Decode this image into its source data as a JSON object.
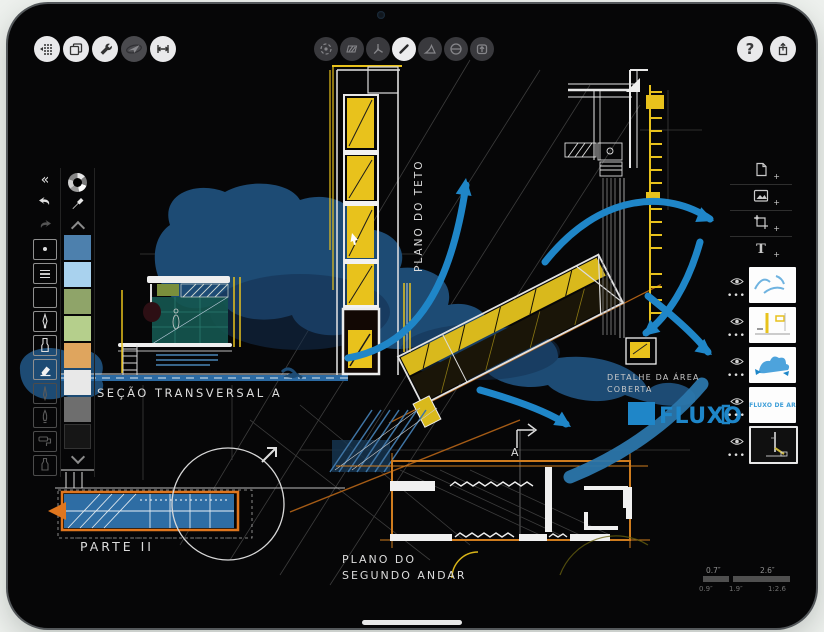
{
  "colors": {
    "accent_blue": "#1f86c8",
    "accent_yellow": "#e8c21c",
    "accent_orange": "#e0761e",
    "blob_blue": "#1d4b74",
    "teal_fill": "#15564f",
    "background": "#eef1ee"
  },
  "top_toolbar": {
    "left_buttons": [
      {
        "icon": "grid-precision-icon"
      },
      {
        "icon": "pages-icon"
      },
      {
        "icon": "wrench-icon"
      },
      {
        "icon": "paper-plane-icon",
        "state": "dimmed"
      },
      {
        "icon": "measure-icon"
      }
    ],
    "center_buttons": [
      {
        "icon": "selection-loop-icon"
      },
      {
        "icon": "hatch-fill-icon"
      },
      {
        "icon": "compass-icon"
      },
      {
        "icon": "line-tool-icon",
        "state": "active"
      },
      {
        "icon": "triangle-tool-icon"
      },
      {
        "icon": "circle-slash-icon"
      },
      {
        "icon": "export-box-icon"
      }
    ],
    "right_buttons": [
      {
        "icon": "help-icon",
        "glyph": "?"
      },
      {
        "icon": "share-icon"
      }
    ]
  },
  "left_panel": {
    "collapse_glyph": "«",
    "undo_icon": "undo-arrow",
    "redo_icon": "redo-arrow",
    "tools": [
      {
        "icon": "dot-tip-icon"
      },
      {
        "icon": "line-weights-icon"
      },
      {
        "icon": "empty-slot"
      },
      {
        "icon": "airbrush-icon"
      },
      {
        "icon": "marker-icon"
      },
      {
        "icon": "eraser-icon",
        "state": "active"
      },
      {
        "icon": "pencil-icon",
        "state": "dimmed"
      },
      {
        "icon": "brush-icon",
        "state": "dimmed"
      },
      {
        "icon": "roller-icon",
        "state": "dimmed"
      },
      {
        "icon": "ink-bottle-icon",
        "state": "dimmed"
      }
    ],
    "palette": {
      "wheel_icon": "color-wheel",
      "dropper_icon": "eyedropper",
      "colors": [
        "#4d80ad",
        "#a9d2ee",
        "#8fa469",
        "#b5cf8c",
        "#dfa55e",
        "#e8e8e8",
        "#6e6e6e",
        "#161616"
      ]
    }
  },
  "right_panel": {
    "add_buttons": [
      {
        "icon": "new-page-icon"
      },
      {
        "icon": "add-image-icon"
      },
      {
        "icon": "crop-icon"
      },
      {
        "icon": "add-text-icon",
        "glyph": "T"
      }
    ],
    "layers": [
      {
        "thumb": "blue-arrow-strokes",
        "visible": true
      },
      {
        "thumb": "plan-sketch",
        "visible": true
      },
      {
        "thumb": "blue-blob",
        "visible": true
      },
      {
        "thumb": "text-layer",
        "label": "FLUXO DE AR",
        "visible": true
      },
      {
        "thumb": "dark-detail-sketch",
        "visible": true,
        "selected": true
      }
    ]
  },
  "canvas": {
    "labels": {
      "section": "SEÇÃO TRANSVERSAL A",
      "ceiling_plan": "PLANO DO TETO",
      "detail_line1": "DETALHE DA ÁREA",
      "detail_line2": "COBERTA",
      "floor_plan_line1": "PLANO DO",
      "floor_plan_line2": "SEGUNDO ANDAR",
      "part": "PARTE II",
      "flux": "FLUXO D",
      "plan_marker": "A"
    },
    "scale_ruler": {
      "top_left": "0.7″",
      "top_right": "2.6″",
      "bottom_left": "0.9″",
      "bottom_mid": "1.9″",
      "bottom_right": "1:2.6"
    }
  }
}
